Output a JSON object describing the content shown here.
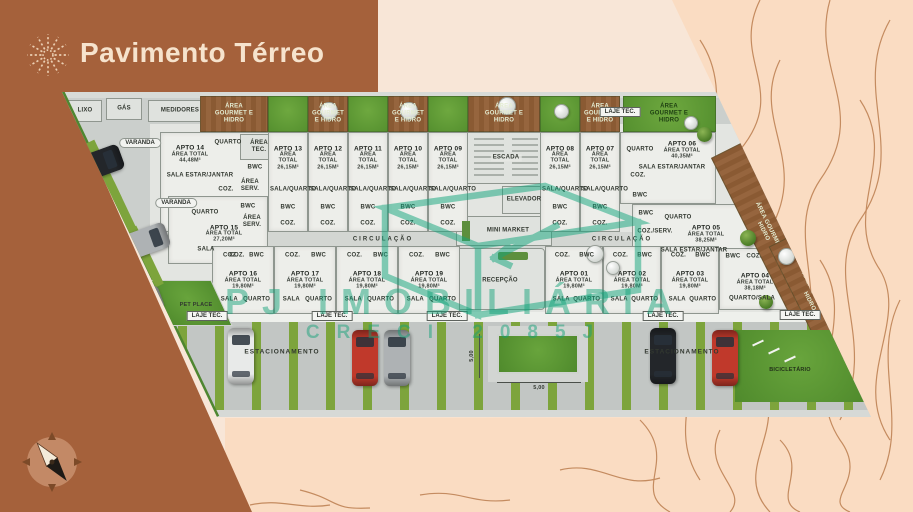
{
  "header": {
    "title": "Pavimento Térreo",
    "logo": "sunburst-icon"
  },
  "watermark": {
    "brand": "PJ IMOBILIÁRIA",
    "creci": "CRECI 2085J"
  },
  "site": {
    "areas": {
      "lixo": "LIXO",
      "gas": "GÁS",
      "medidores": "MEDIDORES",
      "escada": "ESCADA",
      "elevador": "ELEVADOR",
      "mini_market": "MINI MARKET",
      "recepcao": "RECEPÇÃO",
      "circulacao": "CIRCULAÇÃO",
      "laje_tec": "LAJE TEC.",
      "area_tec": "ÁREA TEC.",
      "area_serv": "ÁREA SERV.",
      "varanda": "VARANDA",
      "pet_place": "PET PLACE",
      "estacionamento": "ESTACIONAMENTO",
      "bicicletario": "BICICLETÁRIO",
      "area_gourmet": "ÁREA GOURMET E HIDRO",
      "dimension": "5,00"
    },
    "units_top": [
      {
        "name": "APTO 14",
        "area": "ÁREA TOTAL 44,48m²",
        "rooms": [
          "QUARTO",
          "BWC",
          "SALA ESTAR/JANTAR",
          "COZ."
        ]
      },
      {
        "name": "APTO 13",
        "area": "ÁREA TOTAL 26,15m²",
        "rooms": [
          "SALA/QUARTO",
          "BWC",
          "COZ."
        ]
      },
      {
        "name": "APTO 12",
        "area": "ÁREA TOTAL 26,15m²",
        "rooms": [
          "SALA/QUARTO",
          "BWC",
          "COZ."
        ]
      },
      {
        "name": "APTO 11",
        "area": "ÁREA TOTAL 26,15m²",
        "rooms": [
          "SALA/QUARTO",
          "BWC",
          "COZ."
        ]
      },
      {
        "name": "APTO 10",
        "area": "ÁREA TOTAL 26,15m²",
        "rooms": [
          "SALA/QUARTO",
          "BWC",
          "COZ."
        ]
      },
      {
        "name": "APTO 09",
        "area": "ÁREA TOTAL 26,15m²",
        "rooms": [
          "SALA/QUARTO",
          "BWC",
          "COZ."
        ]
      },
      {
        "name": "APTO 08",
        "area": "ÁREA TOTAL 26,15m²",
        "rooms": [
          "SALA/QUARTO",
          "BWC",
          "COZ."
        ]
      },
      {
        "name": "APTO 07",
        "area": "ÁREA TOTAL 26,15m²",
        "rooms": [
          "SALA/QUARTO",
          "BWC",
          "COZ."
        ]
      },
      {
        "name": "APTO 06",
        "area": "ÁREA TOTAL 40,35m²",
        "rooms": [
          "QUARTO",
          "SALA ESTAR/JANTAR",
          "COZ.",
          "BWC"
        ]
      },
      {
        "name": "APTO 05",
        "area": "ÁREA TOTAL 38,25m²",
        "rooms": [
          "QUARTO",
          "SALA ESTAR/JANTAR",
          "COZ./SERV.",
          "BWC"
        ]
      }
    ],
    "units_bottom": [
      {
        "name": "APTO 15",
        "area": "ÁREA TOTAL 27,20m²",
        "rooms": [
          "QUARTO",
          "BWC",
          "SALA",
          "COZ."
        ]
      },
      {
        "name": "APTO 16",
        "area": "ÁREA TOTAL 19,80m²",
        "rooms": [
          "SALA",
          "QUARTO",
          "COZ.",
          "BWC"
        ]
      },
      {
        "name": "APTO 17",
        "area": "ÁREA TOTAL 19,80m²",
        "rooms": [
          "SALA",
          "QUARTO",
          "COZ.",
          "BWC"
        ]
      },
      {
        "name": "APTO 18",
        "area": "ÁREA TOTAL 19,80m²",
        "rooms": [
          "SALA",
          "QUARTO",
          "COZ.",
          "BWC"
        ]
      },
      {
        "name": "APTO 19",
        "area": "ÁREA TOTAL 19,80m²",
        "rooms": [
          "SALA",
          "QUARTO",
          "COZ.",
          "BWC"
        ]
      },
      {
        "name": "APTO 01",
        "area": "ÁREA TOTAL 19,80m²",
        "rooms": [
          "SALA",
          "QUARTO",
          "COZ.",
          "BWC"
        ]
      },
      {
        "name": "APTO 02",
        "area": "ÁREA TOTAL 19,80m²",
        "rooms": [
          "SALA",
          "QUARTO",
          "COZ.",
          "BWC"
        ]
      },
      {
        "name": "APTO 03",
        "area": "ÁREA TOTAL 19,80m²",
        "rooms": [
          "SALA",
          "QUARTO",
          "COZ.",
          "BWC"
        ]
      },
      {
        "name": "APTO 04",
        "area": "ÁREA TOTAL 38,18m²",
        "rooms": [
          "QUARTO/SALA",
          "COZ.",
          "BWC"
        ]
      }
    ]
  },
  "colors": {
    "header_brown": "#a5613b",
    "title_cream": "#f6e3cd",
    "peach_bg": "#f8e6d7",
    "pattern_peach": "#fadcc2",
    "watermark_green": "#12a57c",
    "grass_green": "#5f9838",
    "stripe_green": "#7da43c",
    "deck_wood": "#8a5a33",
    "pavement_gray": "#c6cac7"
  }
}
